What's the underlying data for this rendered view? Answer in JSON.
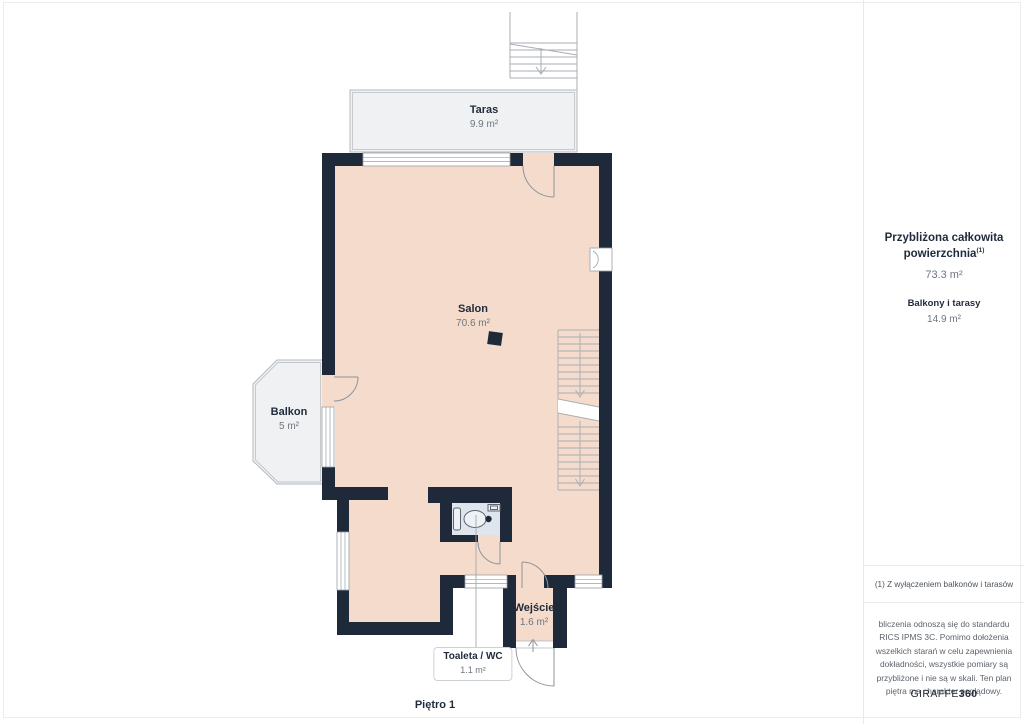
{
  "page": {
    "floor_label": "Piętro 1"
  },
  "floorplan": {
    "rooms": [
      {
        "name": "Taras",
        "area": "9.9 m²"
      },
      {
        "name": "Salon",
        "area": "70.6 m²"
      },
      {
        "name": "Balkon",
        "area": "5 m²"
      },
      {
        "name": "Wejście",
        "area": "1.6 m²"
      },
      {
        "name": "Toaleta / WC",
        "area": "1.1 m²"
      }
    ]
  },
  "sidebar": {
    "total_title": "Przybliżona całkowita powierzchnia",
    "total_title_sup": "(1)",
    "total_value": "73.3 m²",
    "balconies_title": "Balkony i tarasy",
    "balconies_value": "14.9 m²",
    "footnote": "(1) Z wyłączeniem balkonów i tarasów",
    "disclaimer": "bliczenia odnoszą się do standardu RICS IPMS 3C. Pomimo dołożenia wszelkich starań w celu zapewnienia dokładności, wszystkie pomiary są przybliżone i nie są w skali. Ten plan piętra ma charakter poglądowy.",
    "brand_name": "GIRAFFE",
    "brand_suffix": "360"
  },
  "colors": {
    "wall": "#1e2a3a",
    "floor": "#f4dbcb",
    "wet_room_floor": "#dee5ed",
    "outdoor": "#f0f1f2",
    "text_dark": "#1f2b3a",
    "text_gray": "#6e7680"
  }
}
